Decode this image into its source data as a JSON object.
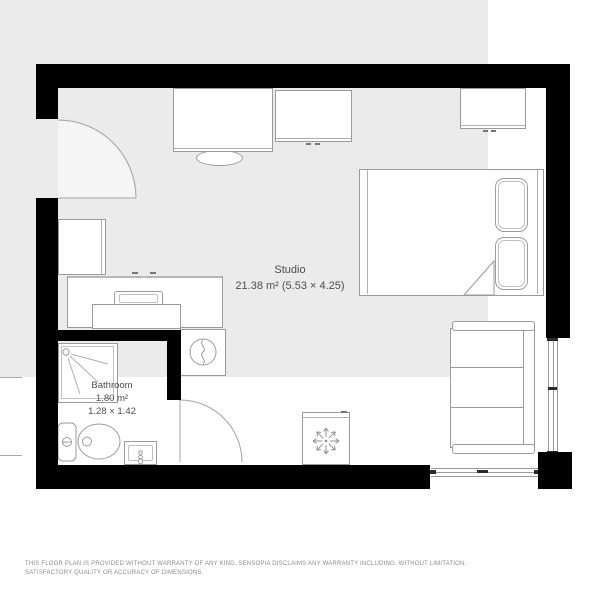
{
  "plan": {
    "studio": {
      "name": "Studio",
      "area": "21.38 m²",
      "dimensions": "(5.53 × 4.25)"
    },
    "bathroom": {
      "name": "Bathroom",
      "area": "1.80 m²",
      "dimensions": "1.28 × 1.42"
    },
    "colors": {
      "wall": "#000000",
      "floor": "#ebebeb",
      "furniture_outline": "#9b9b9b",
      "background": "#ffffff",
      "room_label_text": "#4d4d4d",
      "disclaimer_text": "#8c8c8c"
    },
    "furniture_icons": [
      "desk",
      "desk-chair",
      "cabinet",
      "wardrobe",
      "double-bed",
      "pillow",
      "duvet-fold",
      "sofa",
      "fridge",
      "kitchen-counter",
      "kitchen-sink",
      "kitchen-table",
      "washing-machine",
      "ac-unit",
      "snowflake-icon",
      "shower",
      "shower-head-icon",
      "toilet",
      "washbasin",
      "entry-door",
      "bathroom-door",
      "window"
    ]
  },
  "footer": {
    "disclaimer": "THIS FLOOR PLAN IS PROVIDED WITHOUT WARRANTY OF ANY KIND. SENSOPIA DISCLAIMS ANY WARRANTY INCLUDING, WITHOUT LIMITATION, SATISFACTORY QUALITY OR ACCURACY OF DIMENSIONS."
  }
}
